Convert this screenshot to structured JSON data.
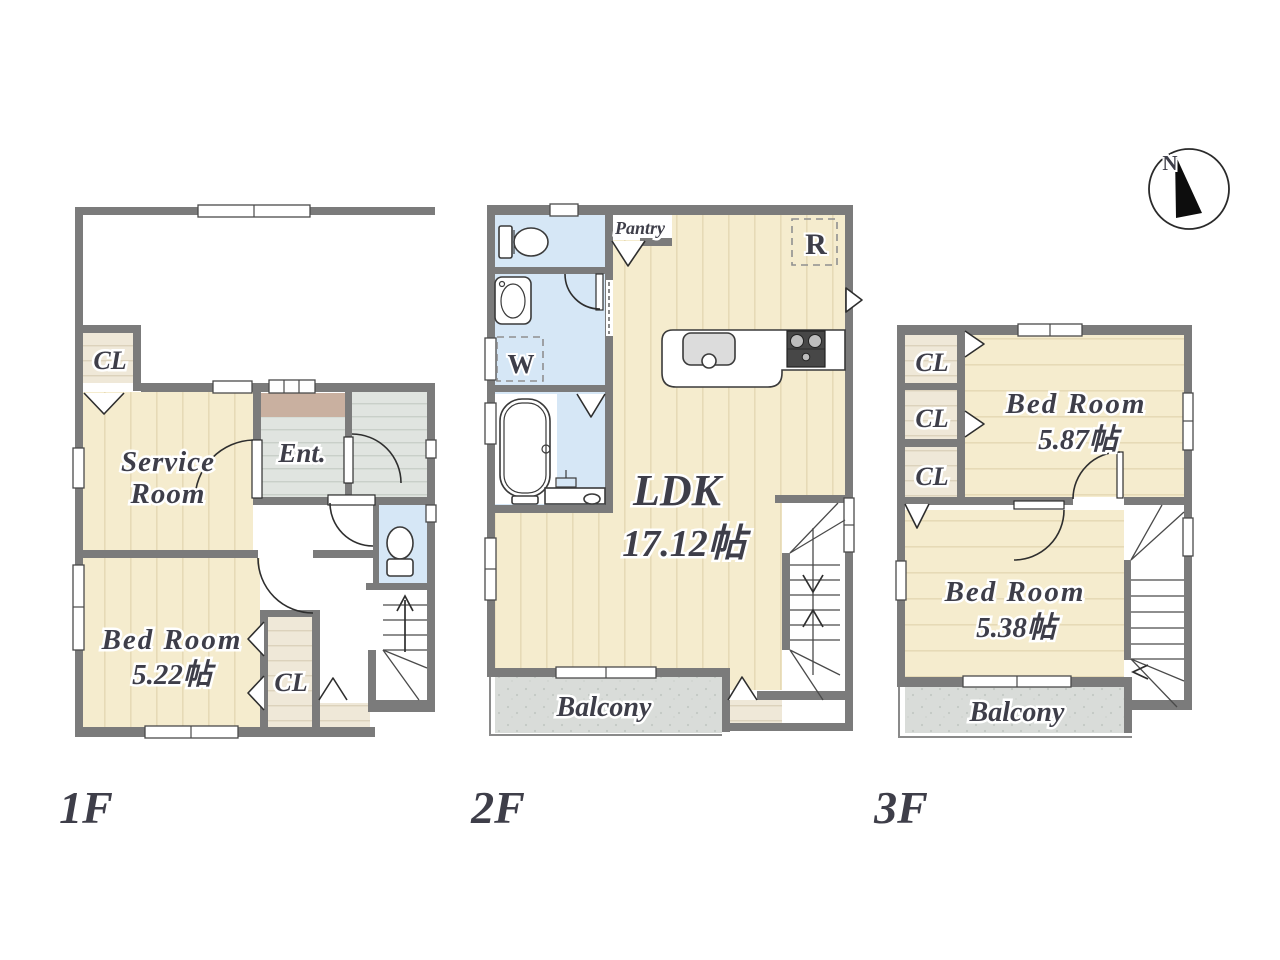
{
  "colors": {
    "wall": "#7b7b7b",
    "wood_floor": "#f5ecce",
    "closet_floor": "#efe8d8",
    "wet_area": "#d6e7f6",
    "tile": "#e0e4e0",
    "balcony": "#d9dcd9",
    "genkan": "#c9b0a0",
    "label_text": "#3e3e49"
  },
  "floor1": {
    "name": "1F",
    "closet_upper": "CL",
    "service_room": [
      "Service",
      "Room"
    ],
    "entrance": "Ent.",
    "bedroom": [
      "Bed Room",
      "5.22帖"
    ],
    "closet_lower": "CL"
  },
  "floor2": {
    "name": "2F",
    "pantry": "Pantry",
    "refrigerator": "R",
    "washer": "W",
    "ldk": [
      "LDK",
      "17.12帖"
    ],
    "balcony": "Balcony"
  },
  "floor3": {
    "name": "3F",
    "closets": [
      "CL",
      "CL",
      "CL"
    ],
    "bedroom_upper": [
      "Bed Room",
      "5.87帖"
    ],
    "bedroom_lower": [
      "Bed Room",
      "5.38帖"
    ],
    "balcony": "Balcony"
  },
  "compass": {
    "north": "N"
  }
}
